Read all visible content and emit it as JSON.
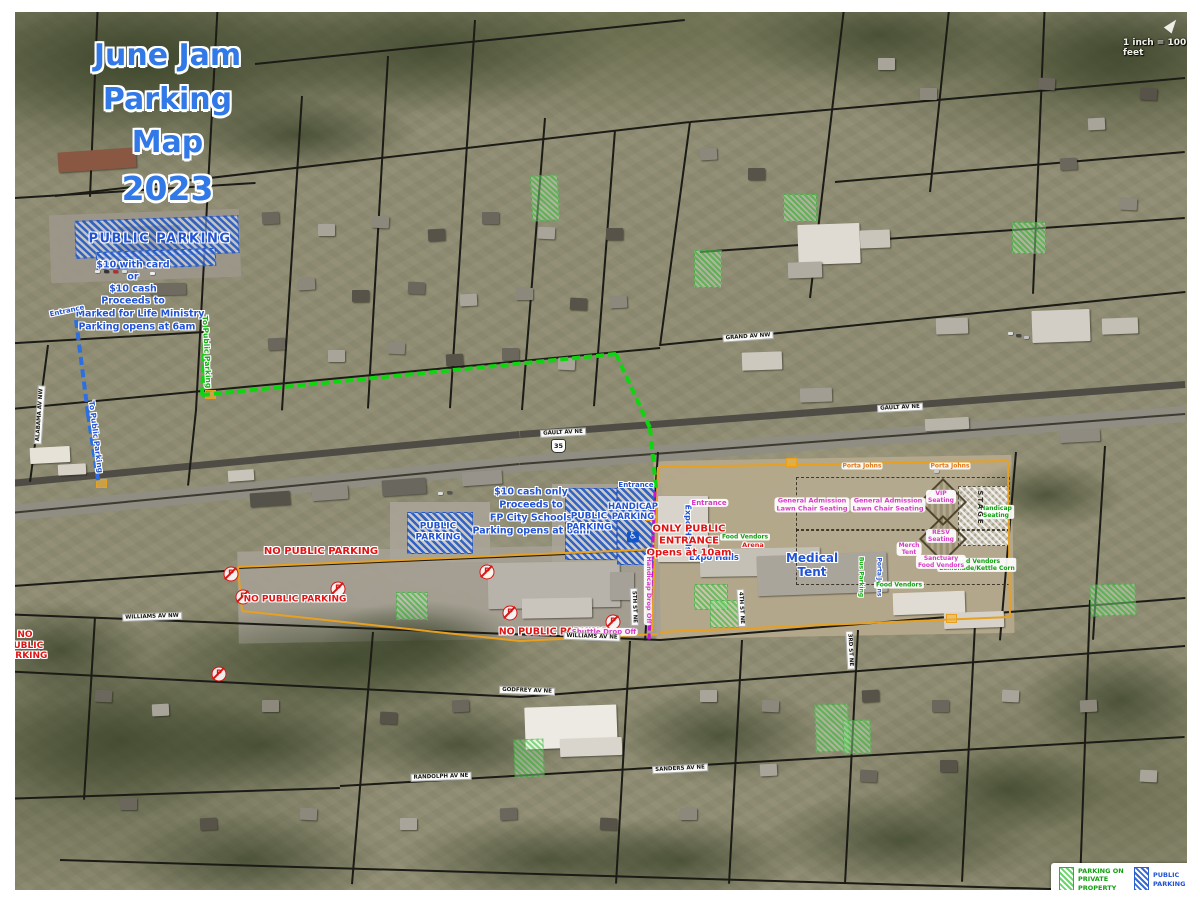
{
  "title": {
    "lines": [
      "June Jam",
      "Parking Map",
      "2023"
    ]
  },
  "scale": {
    "text": "1 inch = 100 feet"
  },
  "road_shield": {
    "text": "35"
  },
  "legend": {
    "private_label": "PARKING ON\nPRIVATE\nPROPERTY",
    "public_label": "PUBLIC\nPARKING",
    "disclaimer": "***PARK AT YOUR OWN RISK***"
  },
  "colors": {
    "public_parking_blue": "#2b6fe0",
    "private_parking_green": "#46c846",
    "route_green": "#0ed60e",
    "route_blue": "#2b6fe0",
    "route_purple": "#c416d8",
    "no_parking_red": "#e01414",
    "venue_pink": "#d83cc8",
    "boundary_orange": "#e8a020",
    "title_blue": "#3279e8"
  },
  "icons": {
    "no_parking_letter": "P",
    "handicap_symbol": "♿"
  },
  "np_icons": [
    {
      "x": 231,
      "y": 574
    },
    {
      "x": 243,
      "y": 597
    },
    {
      "x": 338,
      "y": 589
    },
    {
      "x": 487,
      "y": 572
    },
    {
      "x": 510,
      "y": 613
    },
    {
      "x": 613,
      "y": 622
    },
    {
      "x": 219,
      "y": 674
    }
  ],
  "map_labels": [
    {
      "name": "label-public-parking-north",
      "text": "PUBLIC PARKING",
      "x": 160,
      "y": 239,
      "cls": "blue out",
      "size": 13,
      "ls": 1.5
    },
    {
      "name": "label-price-card",
      "text": "$10 with card",
      "x": 133,
      "y": 265,
      "cls": "blue out",
      "size": 9.5
    },
    {
      "name": "label-price-or",
      "text": "or",
      "x": 133,
      "y": 277,
      "cls": "blue out",
      "size": 9.5
    },
    {
      "name": "label-price-cash",
      "text": "$10 cash",
      "x": 133,
      "y": 289,
      "cls": "blue out",
      "size": 9.5
    },
    {
      "name": "label-proceeds-north",
      "text": "Proceeds to",
      "x": 133,
      "y": 301,
      "cls": "blue out",
      "size": 9.5
    },
    {
      "name": "label-ministry",
      "text": "Marked for Life Ministry",
      "x": 140,
      "y": 314,
      "cls": "blue out",
      "size": 9.5
    },
    {
      "name": "label-opens-north",
      "text": "Parking opens at 6am",
      "x": 137,
      "y": 327,
      "cls": "blue out",
      "size": 9.5
    },
    {
      "name": "label-entrance-northwest",
      "text": "Entrance",
      "x": 67,
      "y": 311,
      "cls": "blue out",
      "size": 7,
      "rot": -12
    },
    {
      "name": "label-route-blue",
      "text": "To Public Parking",
      "x": 95,
      "y": 437,
      "cls": "blue out",
      "size": 7.5,
      "rot": 83
    },
    {
      "name": "label-route-green",
      "text": "To Public Parking",
      "x": 206,
      "y": 352,
      "cls": "green out",
      "size": 7.5,
      "rot": 87
    },
    {
      "name": "label-cash-only",
      "text": "$10 cash only",
      "x": 531,
      "y": 492,
      "cls": "blue out",
      "size": 9.5
    },
    {
      "name": "label-proceeds-mid",
      "text": "Proceeds to",
      "x": 531,
      "y": 505,
      "cls": "blue out",
      "size": 9.5
    },
    {
      "name": "label-fp-schools",
      "text": "FP City Schools",
      "x": 531,
      "y": 518,
      "cls": "blue out",
      "size": 9.5
    },
    {
      "name": "label-opens-mid",
      "text": "Parking opens at 6am",
      "x": 531,
      "y": 531,
      "cls": "blue out",
      "size": 9.5
    },
    {
      "name": "label-public-parking-west",
      "text": "PUBLIC\nPARKING",
      "x": 438,
      "y": 532,
      "cls": "blue out",
      "size": 9
    },
    {
      "name": "label-public-parking-mid",
      "text": "PUBLIC\nPARKING",
      "x": 589,
      "y": 522,
      "cls": "blue out",
      "size": 9
    },
    {
      "name": "label-handicap-parking",
      "text": "HANDICAP\nPARKING",
      "x": 633,
      "y": 512,
      "cls": "blue out",
      "size": 8.5
    },
    {
      "name": "handicap-parking-icon",
      "text": "♿",
      "x": 633,
      "y": 537,
      "cls": "hcp",
      "size": 9
    },
    {
      "name": "label-entrance-gate",
      "text": "Entrance",
      "x": 636,
      "y": 485,
      "cls": "blue out",
      "size": 7
    },
    {
      "name": "label-expo-halls-vertical",
      "text": "Expo Halls",
      "x": 688,
      "y": 528,
      "cls": "blue out",
      "size": 8,
      "rot": 90
    },
    {
      "name": "label-expo-halls",
      "text": "Expo Halls",
      "x": 714,
      "y": 558,
      "cls": "blue out",
      "size": 8.5
    },
    {
      "name": "label-medical-tent",
      "text": "Medical\nTent",
      "x": 812,
      "y": 565,
      "cls": "blue out",
      "size": 12
    },
    {
      "name": "label-porta-johns-vertical",
      "text": "Porta Johns",
      "x": 879,
      "y": 577,
      "cls": "blue out",
      "size": 6,
      "rot": 90
    },
    {
      "name": "label-food-vendors-1",
      "text": "Food Vendors",
      "x": 745,
      "y": 537,
      "cls": "greenbox",
      "size": 6
    },
    {
      "name": "label-handicap-seating",
      "text": "Handicap\nSeating",
      "x": 996,
      "y": 512,
      "cls": "greenbox",
      "size": 6
    },
    {
      "name": "label-food-vendors-lemonade",
      "text": "Food Vendors\nLemonade/Kettle Corn",
      "x": 977,
      "y": 565,
      "cls": "greenbox",
      "size": 6
    },
    {
      "name": "label-food-vendors-2",
      "text": "Food Vendors",
      "x": 899,
      "y": 585,
      "cls": "greenbox",
      "size": 6
    },
    {
      "name": "label-bus-parking",
      "text": "Bus Parking",
      "x": 861,
      "y": 577,
      "cls": "green out",
      "size": 6,
      "rot": 90
    },
    {
      "name": "label-no-parking-1",
      "text": "NO PUBLIC PARKING",
      "x": 321,
      "y": 552,
      "cls": "red out",
      "size": 10
    },
    {
      "name": "label-no-parking-2",
      "text": "NO PUBLIC PARKING",
      "x": 295,
      "y": 600,
      "cls": "red out",
      "size": 9
    },
    {
      "name": "label-no-parking-3",
      "text": "NO\nPUBLIC\nPARKING",
      "x": 25,
      "y": 646,
      "cls": "red out",
      "size": 9
    },
    {
      "name": "label-no-parking-4",
      "text": "NO PUBLIC PARKING",
      "x": 553,
      "y": 632,
      "cls": "red out",
      "size": 9.5
    },
    {
      "name": "label-only-public-entrance",
      "text": "ONLY PUBLIC\nENTRANCE\nOpens at 10am",
      "x": 689,
      "y": 541,
      "cls": "red out",
      "size": 10
    },
    {
      "name": "label-arena",
      "text": "Arena",
      "x": 753,
      "y": 546,
      "cls": "red out",
      "size": 6.5
    },
    {
      "name": "label-entrance-venue",
      "text": "Entrance",
      "x": 709,
      "y": 503,
      "cls": "pink",
      "size": 7
    },
    {
      "name": "label-ga-seating-1",
      "text": "General Admission\nLawn Chair Seating",
      "x": 812,
      "y": 505,
      "cls": "pink",
      "size": 6.5
    },
    {
      "name": "label-ga-seating-2",
      "text": "General Admission\nLawn Chair Seating",
      "x": 888,
      "y": 505,
      "cls": "pink",
      "size": 6.5
    },
    {
      "name": "label-vip-seating",
      "text": "VIP\nSeating",
      "x": 941,
      "y": 497,
      "cls": "pink",
      "size": 6
    },
    {
      "name": "label-resv-seating",
      "text": "RESV\nSeating",
      "x": 941,
      "y": 536,
      "cls": "pink",
      "size": 6
    },
    {
      "name": "label-merch-tent",
      "text": "Merch\nTent",
      "x": 909,
      "y": 549,
      "cls": "pink",
      "size": 6
    },
    {
      "name": "label-sanctuary",
      "text": "Sanctuary\nFood Vendors",
      "x": 941,
      "y": 562,
      "cls": "pink",
      "size": 6
    },
    {
      "name": "label-shuttle-drop-off",
      "text": "Shuttle Drop Off",
      "x": 604,
      "y": 632,
      "cls": "pink",
      "size": 7
    },
    {
      "name": "label-handicap-drop-off",
      "text": "Handicap Drop Off",
      "x": 648,
      "y": 590,
      "cls": "pink",
      "size": 6.5,
      "rot": 90
    },
    {
      "name": "label-porta-johns-1",
      "text": "Porta Johns",
      "x": 862,
      "y": 466,
      "cls": "orange",
      "size": 6
    },
    {
      "name": "label-porta-johns-2",
      "text": "Porta Johns",
      "x": 950,
      "y": 466,
      "cls": "orange",
      "size": 6
    },
    {
      "name": "label-stage",
      "text": "STAGE",
      "x": 980,
      "y": 508,
      "cls": "dark",
      "size": 7,
      "rot": 90,
      "ls": 2
    },
    {
      "name": "street-gault-1",
      "text": "GAULT AV NE",
      "x": 563,
      "y": 433,
      "cls": "street",
      "size": 5.5,
      "rot": -3
    },
    {
      "name": "street-gault-2",
      "text": "GAULT AV NE",
      "x": 900,
      "y": 408,
      "cls": "street",
      "size": 5.5,
      "rot": -3
    },
    {
      "name": "street-williams-ne",
      "text": "WILLIAMS AV NE",
      "x": 592,
      "y": 637,
      "cls": "street",
      "size": 5.5,
      "rot": 2
    },
    {
      "name": "street-williams-nw",
      "text": "WILLIAMS AV NW",
      "x": 152,
      "y": 617,
      "cls": "street",
      "size": 5.5,
      "rot": -2
    },
    {
      "name": "street-grand",
      "text": "GRAND AV NW",
      "x": 748,
      "y": 337,
      "cls": "street",
      "size": 5.5,
      "rot": -4
    },
    {
      "name": "street-alabama",
      "text": "ALABAMA AV NW",
      "x": 40,
      "y": 415,
      "cls": "street",
      "size": 5.5,
      "rot": -86
    },
    {
      "name": "street-godfrey",
      "text": "GODFREY AV NE",
      "x": 527,
      "y": 691,
      "cls": "street",
      "size": 5.5,
      "rot": 2
    },
    {
      "name": "street-sanders",
      "text": "SANDERS AV NE",
      "x": 680,
      "y": 769,
      "cls": "street",
      "size": 5.5,
      "rot": -3
    },
    {
      "name": "street-randolph",
      "text": "RANDOLPH AV NE",
      "x": 441,
      "y": 777,
      "cls": "street",
      "size": 5.5,
      "rot": -2
    },
    {
      "name": "street-5th",
      "text": "5TH ST NE",
      "x": 634,
      "y": 607,
      "cls": "street",
      "size": 5.5,
      "rot": 88
    },
    {
      "name": "street-4th",
      "text": "4TH ST NE",
      "x": 741,
      "y": 608,
      "cls": "street",
      "size": 5.5,
      "rot": 87
    },
    {
      "name": "street-3rd",
      "text": "3RD ST NE",
      "x": 850,
      "y": 650,
      "cls": "street",
      "size": 5.5,
      "rot": 87
    }
  ]
}
